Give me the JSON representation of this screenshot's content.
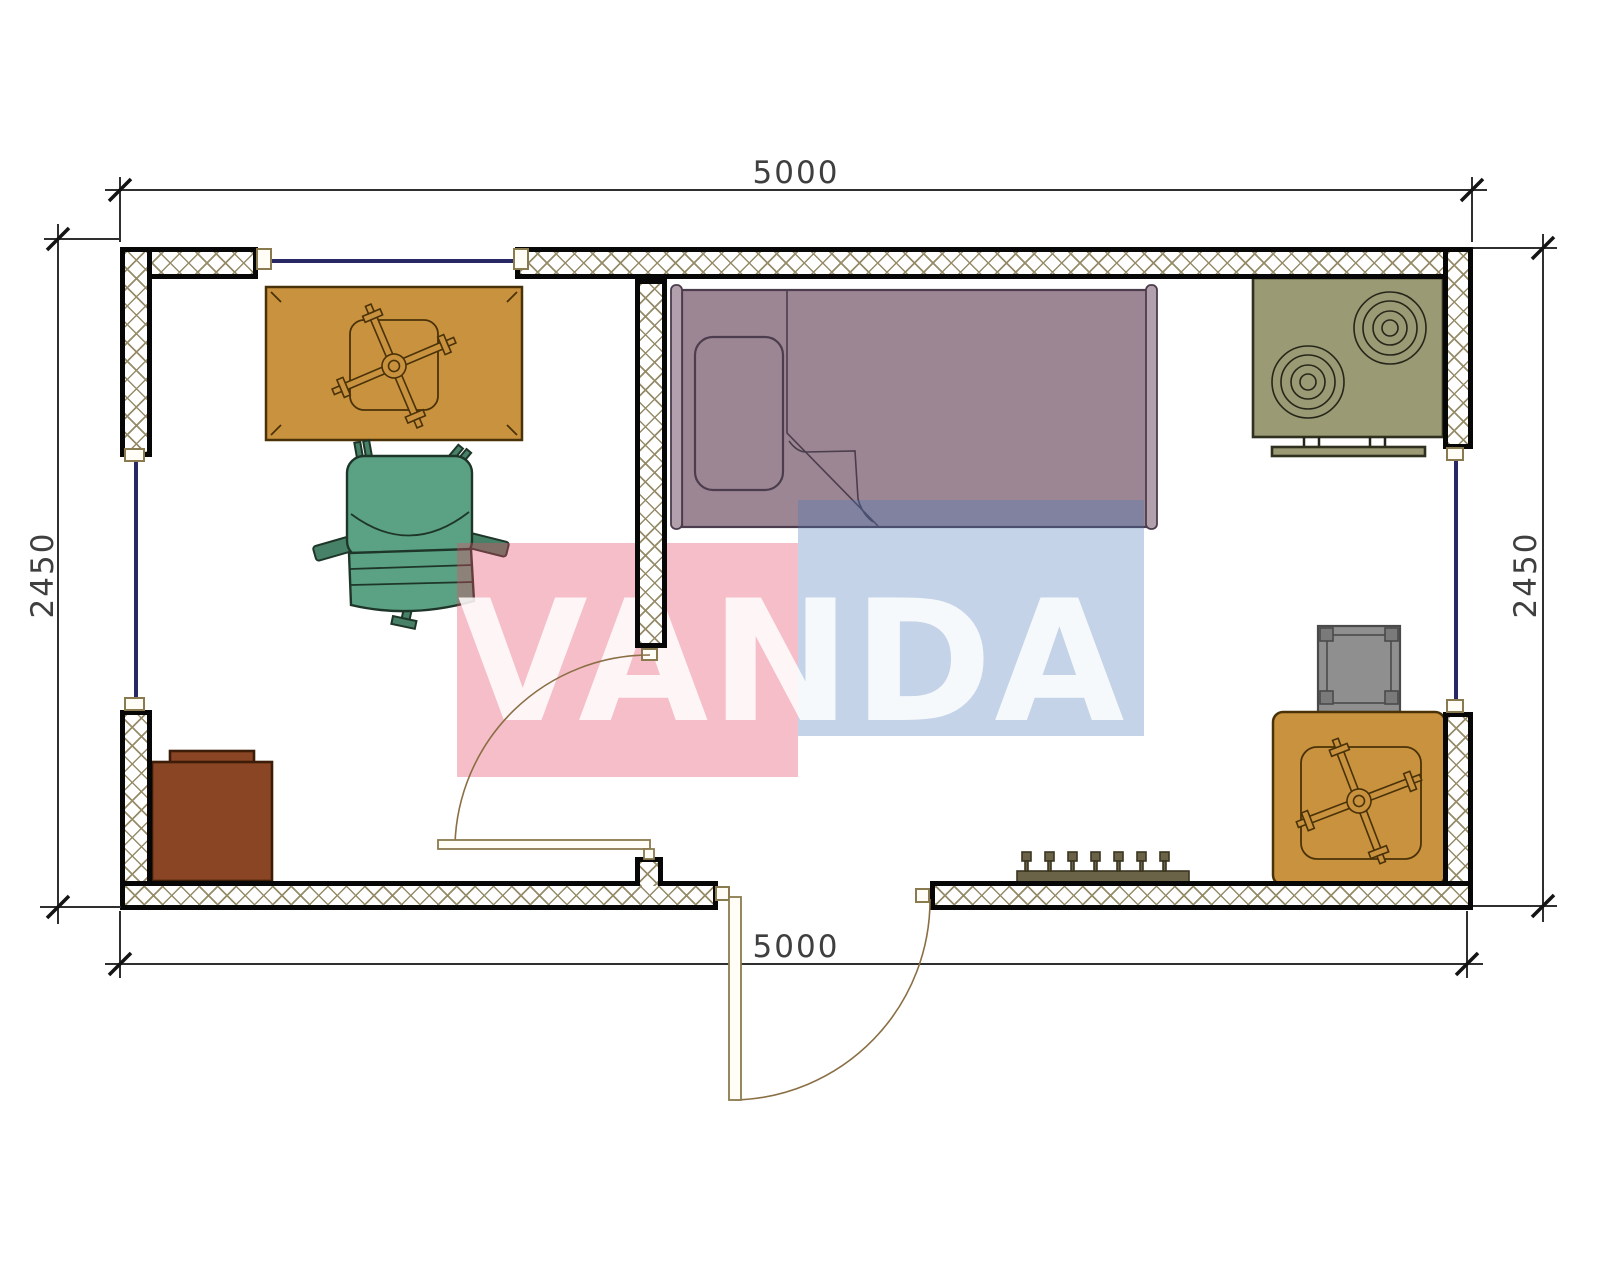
{
  "plan_type": "floor-plan",
  "watermark": {
    "text": "VANDA"
  },
  "dimensions": {
    "top": "5000",
    "bottom": "5000",
    "left": "2450",
    "right": "2450"
  },
  "rooms": [
    {
      "name": "living-room",
      "furniture": [
        "desk-with-chair",
        "office-chair",
        "cabinet"
      ]
    },
    {
      "name": "bedroom",
      "furniture": [
        "single-bed",
        "stove-two-burners",
        "side-table-gray",
        "table-with-chair",
        "radiator"
      ]
    }
  ],
  "openings": {
    "windows": [
      "top-wall-window",
      "left-wall-window",
      "right-wall-window"
    ],
    "doors": [
      "interior-door",
      "entry-door"
    ]
  },
  "colors": {
    "wall-hatch": "#968c69",
    "window-line": "#282864",
    "door-tan": "#8a7a50",
    "table-tan": "#c9923e",
    "table-outline": "#4a3208",
    "chair-green": "#5ba184",
    "chair-outline": "#1e3629",
    "bed-fill": "#9c8694",
    "bed-outline": "#4b3d4d",
    "stove-fill": "#9a9a74",
    "cabinet-brown": "#8a4525",
    "gray-table": "#8f8f8f",
    "radiator": "#6b6347",
    "dim-color": "#3f3f3f",
    "wm-pink": "rgba(231,76,102,0.36)",
    "wm-blue": "rgba(75,120,185,0.33)",
    "wm-text": "rgba(255,255,255,0.85)"
  }
}
